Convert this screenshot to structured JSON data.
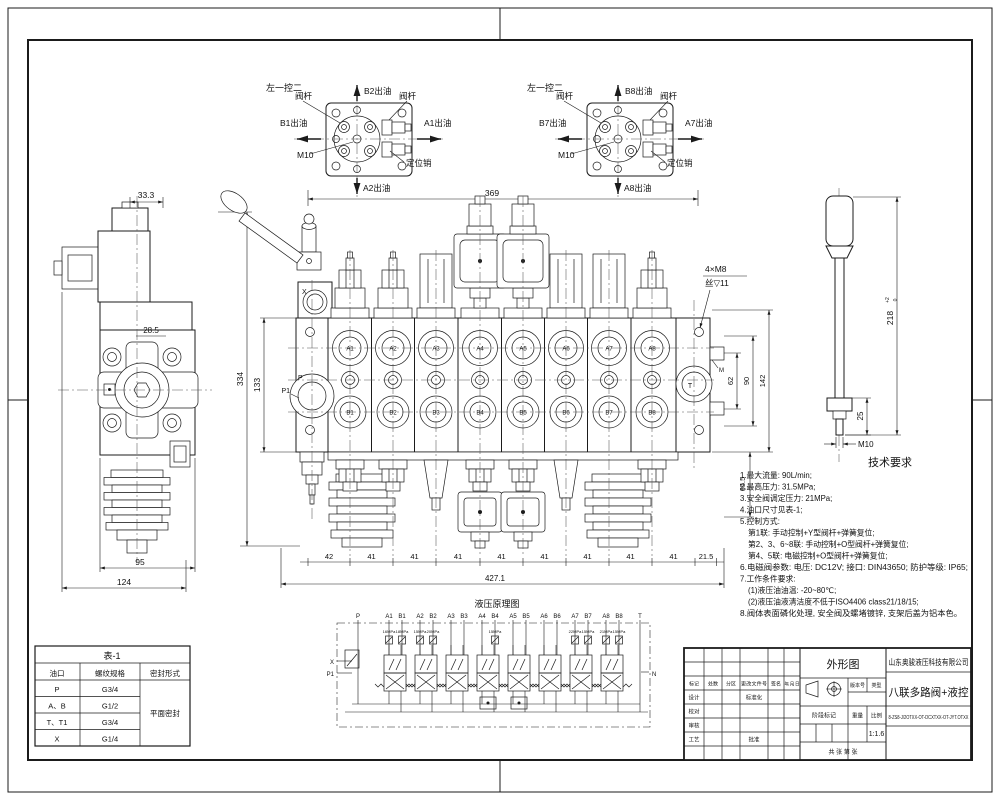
{
  "top_views": {
    "left": {
      "corner": "左一控二",
      "stem_left": "阀杆",
      "stem_right": "阀杆",
      "out_top": "B2出油",
      "out_left": "B1出油",
      "out_right": "A1出油",
      "out_bottom": "A2出油",
      "thread": "M10",
      "pin": "定位销"
    },
    "right": {
      "corner": "左一控二",
      "stem_left": "阀杆",
      "stem_right": "阀杆",
      "out_top": "B8出油",
      "out_left": "B7出油",
      "out_right": "A7出油",
      "out_bottom": "A8出油",
      "thread": "M10",
      "pin": "定位销"
    }
  },
  "side_view": {
    "dim_33_3": "33.3",
    "dim_28_5": "28.5",
    "dim_95": "95",
    "dim_124": "124"
  },
  "main_view": {
    "dim_369": "369",
    "dim_334": "334",
    "dim_133": "133",
    "dim_total": "427.1",
    "dim_62": "62",
    "dim_90": "90",
    "dim_142": "142",
    "dim_65_5": "65.5",
    "chain": [
      "42",
      "41",
      "41",
      "41",
      "41",
      "41",
      "41",
      "41",
      "41",
      "21.5"
    ],
    "bolt_note_1": "4×M8",
    "bolt_note_2": "丝▽11",
    "ports_a": [
      "A1",
      "A2",
      "A3",
      "A4",
      "A5",
      "A6",
      "A7",
      "A8"
    ],
    "ports_b": [
      "B1",
      "B2",
      "B3",
      "B4",
      "B5",
      "B6",
      "B7",
      "B8"
    ],
    "label_x": "X",
    "label_p": "P",
    "label_p1": "P1",
    "label_t": "T",
    "label_m": "M"
  },
  "lever_detail": {
    "dim_len": "218",
    "tol_up": "+2",
    "tol_dn": "0",
    "dim_25": "25",
    "thread": "M10"
  },
  "tech": {
    "title": "技术要求",
    "lines": [
      "1.最大流量: 90L/min;",
      "2.最高压力: 31.5MPa;",
      "3.安全阀调定压力: 21MPa;",
      "4.油口尺寸见表-1;",
      "5.控制方式:",
      "第1联: 手动控制+Y型阀杆+弹簧复位;",
      "第2、3、6~8联: 手动控制+O型阀杆+弹簧复位;",
      "第4、5联: 电磁控制+O型阀杆+弹簧复位;",
      "6.电磁阀参数: 电压: DC12V; 接口: DIN43650; 防护等级: IP65;",
      "7.工作条件要求:",
      "(1)液压油油温: -20~80℃;",
      "(2)液压油液清洁度不低于ISO4406 class21/18/15;",
      "8.阀体表面磷化处理, 安全阀及螺堵镀锌, 支架后盖为铝本色。"
    ]
  },
  "table1": {
    "title": "表-1",
    "col_port": "油口",
    "col_thread": "螺纹规格",
    "col_seal": "密封形式",
    "rows": [
      {
        "port": "P",
        "thread": "G3/4"
      },
      {
        "port": "A、B",
        "thread": "G1/2"
      },
      {
        "port": "T、T1",
        "thread": "G3/4"
      },
      {
        "port": "X",
        "thread": "G1/4"
      }
    ],
    "seal": "平面密封"
  },
  "schematic": {
    "title": "液压原理图",
    "ports": [
      "P",
      "A1",
      "B1",
      "A2",
      "B2",
      "A3",
      "B3",
      "A4",
      "B4",
      "A5",
      "B5",
      "A6",
      "B6",
      "A7",
      "B7",
      "A8",
      "B8",
      "T"
    ],
    "label_x": "X",
    "label_p1": "P1",
    "label_n": "N",
    "pressures": [
      "16MPa",
      "18MPa",
      "15MPa",
      "20MPa",
      "15MPa",
      "22MPa",
      "15MPa",
      "21MPa",
      "15MPa"
    ]
  },
  "title_block": {
    "drawing_title": "外形图",
    "company": "山东奥骏液压科技有限公司",
    "product": "八联多路阀+液控",
    "part_number": "8-ZS8-J/2OTXX-OT-DCXTXX-OT-JYT.OTXX",
    "scale_value": "1:1.6",
    "labels": {
      "mark": "标记",
      "qty": "处数",
      "zone": "分区",
      "doc": "更改文件号",
      "sign": "签名",
      "date": "年、月、日",
      "design": "设计",
      "std": "标准化",
      "check": "校对",
      "audit": "审核",
      "craft": "工艺",
      "approve": "批准",
      "stage": "阶段标记",
      "weight": "重量",
      "scale": "比例",
      "version": "版本号",
      "type": "类型",
      "sheets": "共 张 第 张"
    }
  }
}
